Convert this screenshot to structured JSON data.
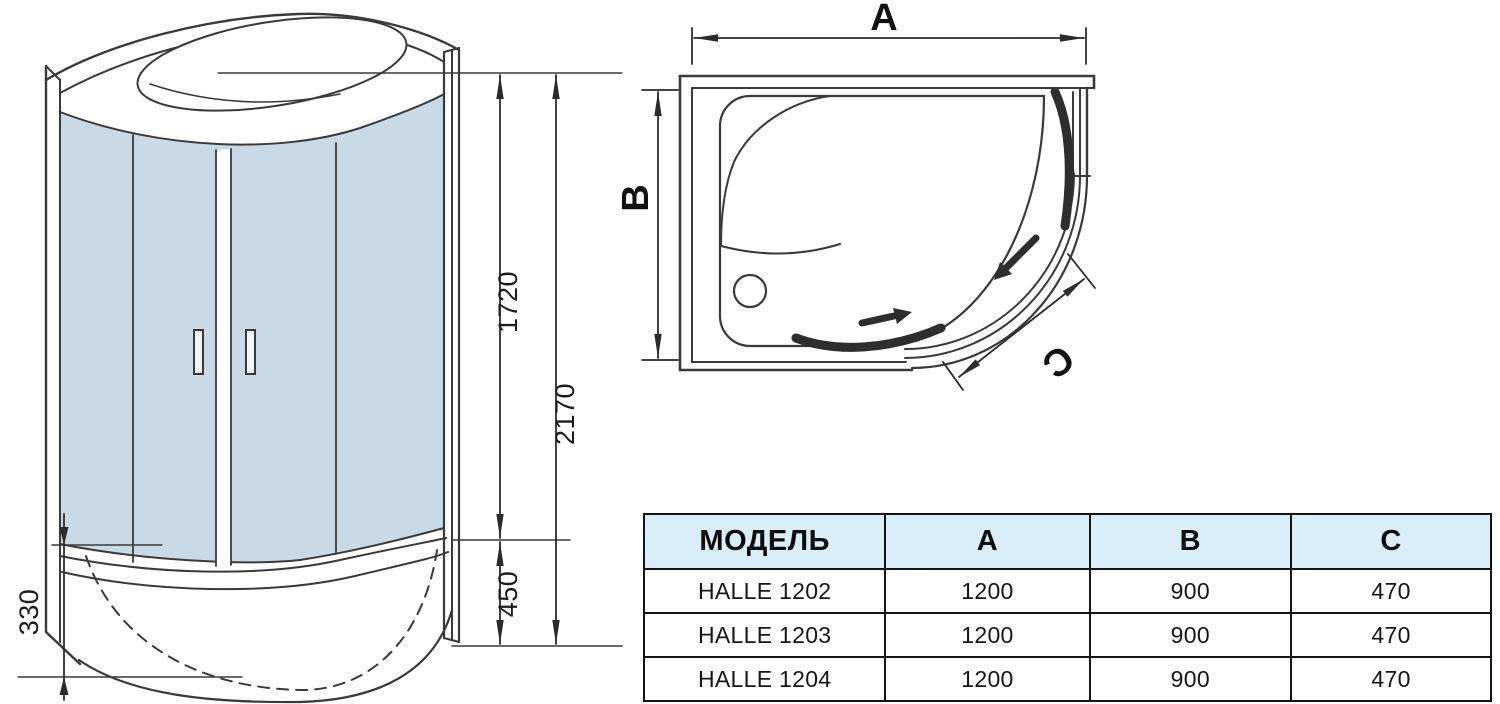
{
  "front_view": {
    "dim_glass_height": "1720",
    "dim_total_height": "2170",
    "dim_tray_front_height": "450",
    "dim_tray_side_height": "330"
  },
  "plan_view": {
    "dim_width_label": "A",
    "dim_depth_label": "B",
    "dim_door_label": "C"
  },
  "table": {
    "headers": [
      "МОДЕЛЬ",
      "A",
      "B",
      "C"
    ],
    "rows": [
      [
        "HALLE 1202",
        "1200",
        "900",
        "470"
      ],
      [
        "HALLE 1203",
        "1200",
        "900",
        "470"
      ],
      [
        "HALLE 1204",
        "1200",
        "900",
        "470"
      ]
    ]
  },
  "colors": {
    "glass": "#c9dae6",
    "line": "#3a3a3a",
    "table_header_bg": "#daeef9",
    "table_border": "#141414"
  }
}
